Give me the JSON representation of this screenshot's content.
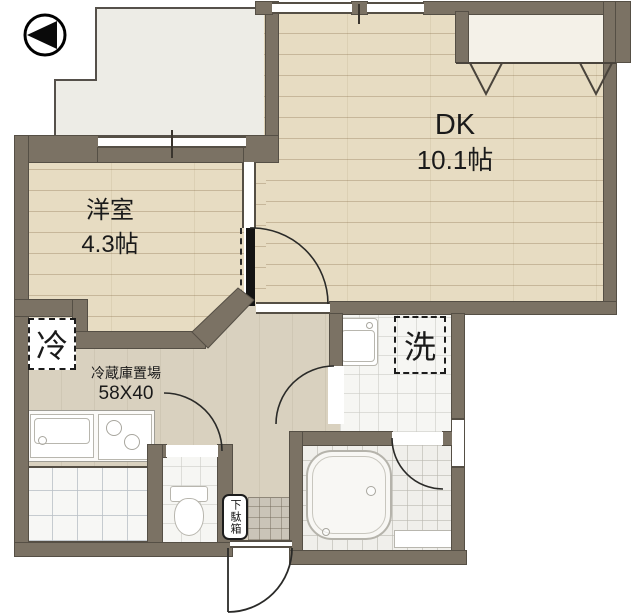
{
  "rooms": {
    "dk": {
      "label": "DK",
      "area": "10.1帖"
    },
    "western": {
      "label": "洋室",
      "area": "4.3帖"
    }
  },
  "annotations": {
    "fridge_symbol": "冷",
    "fridge_area_label": "冷蔵庫置場",
    "fridge_area_size": "58X40",
    "washer_symbol": "洗",
    "shoe_cabinet": "下駄箱"
  },
  "icons": {
    "compass": "north-arrow pointing left"
  },
  "colors": {
    "wall": "#7b7264",
    "wood_floor": "#e7dcc2",
    "hall_floor": "#d9d1bf",
    "balcony": "#edece6",
    "entry_tile": "#cac4b8",
    "line": "#554f45",
    "text": "#1a1a1a"
  }
}
